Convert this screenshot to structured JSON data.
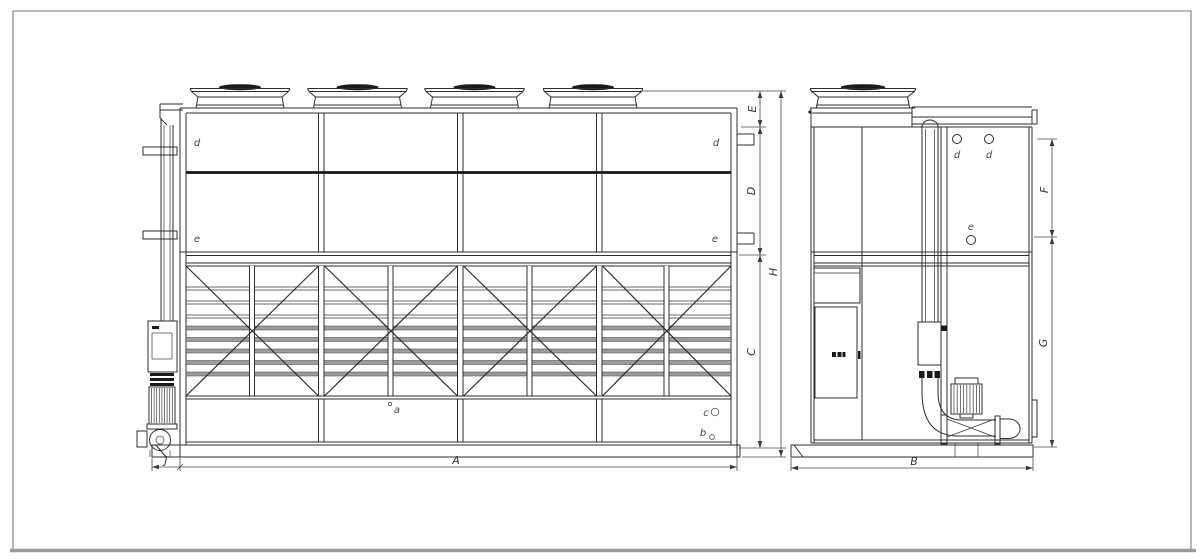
{
  "front_view": {
    "dim_labels": {
      "A": "A",
      "J": "J",
      "E": "E",
      "D": "D",
      "C": "C",
      "H": "H"
    },
    "port_labels": {
      "d_left": "d",
      "e_left": "e",
      "d_right": "d",
      "e_right": "e"
    },
    "basin_labels": {
      "a": "a",
      "b": "b",
      "c": "c"
    }
  },
  "side_view": {
    "dim_labels": {
      "B": "B",
      "F": "F",
      "G": "G"
    },
    "port_labels": {
      "d1": "d",
      "d2": "d",
      "e": "e"
    }
  },
  "colors": {
    "line": "#2e2e2e",
    "dimension_line": "#4a4a4a",
    "louver_grey": "#9c9c9c",
    "dark_fill": "#1a1a1a",
    "frame": "#555555",
    "frame_bottom": "#9a9a9a",
    "background": "#ffffff"
  }
}
